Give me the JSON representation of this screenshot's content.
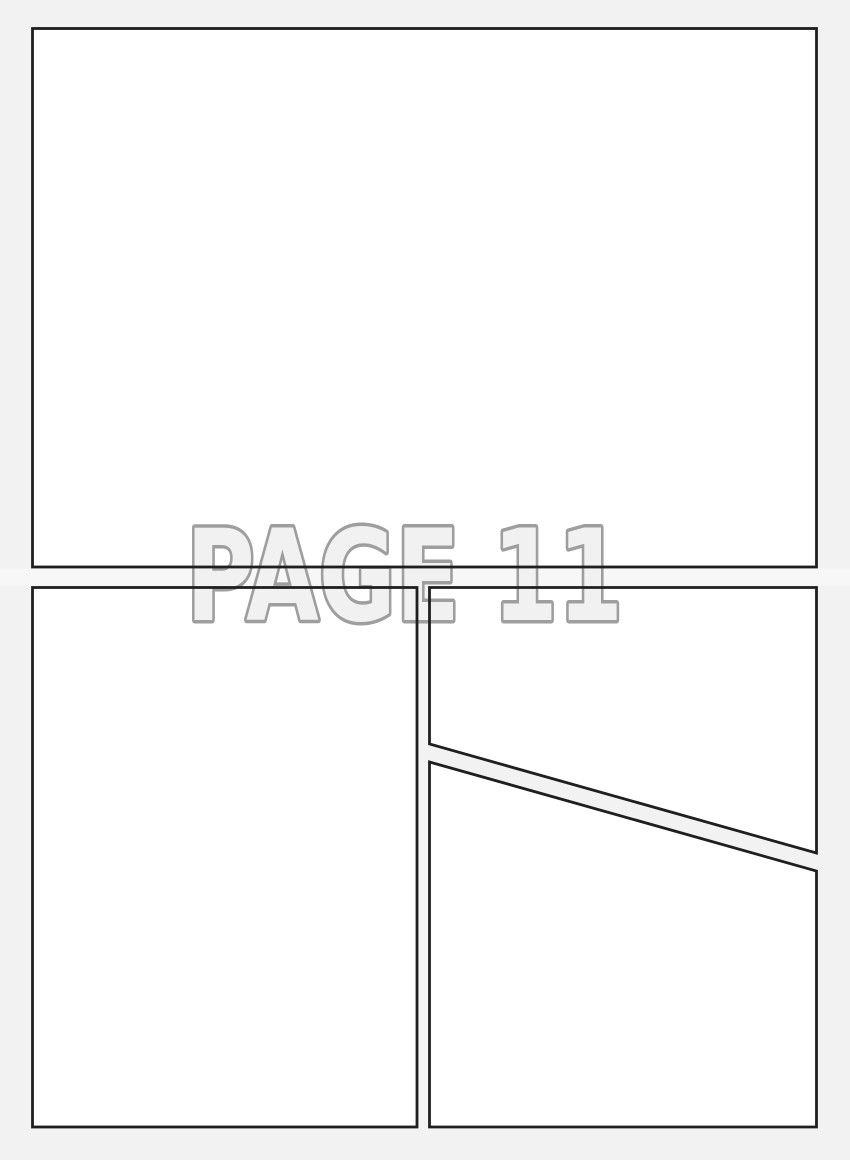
{
  "page_label": {
    "text": "PAGE 11"
  },
  "panels": {
    "count": 4,
    "items": [
      {
        "name": "panel-1",
        "position": "top full-width rectangle"
      },
      {
        "name": "panel-2",
        "position": "bottom-left tall rectangle"
      },
      {
        "name": "panel-3",
        "position": "bottom-right upper, diagonal bottom edge"
      },
      {
        "name": "panel-4",
        "position": "bottom-right lower, diagonal top edge"
      }
    ]
  },
  "colors": {
    "background": "#f2f2f2",
    "gutter_band": "#f7f7f7",
    "panel_fill": "#ffffff",
    "panel_border": "#1f1f1f",
    "label_fill": "#f1f1f1",
    "label_outline": "#9e9e9e"
  }
}
